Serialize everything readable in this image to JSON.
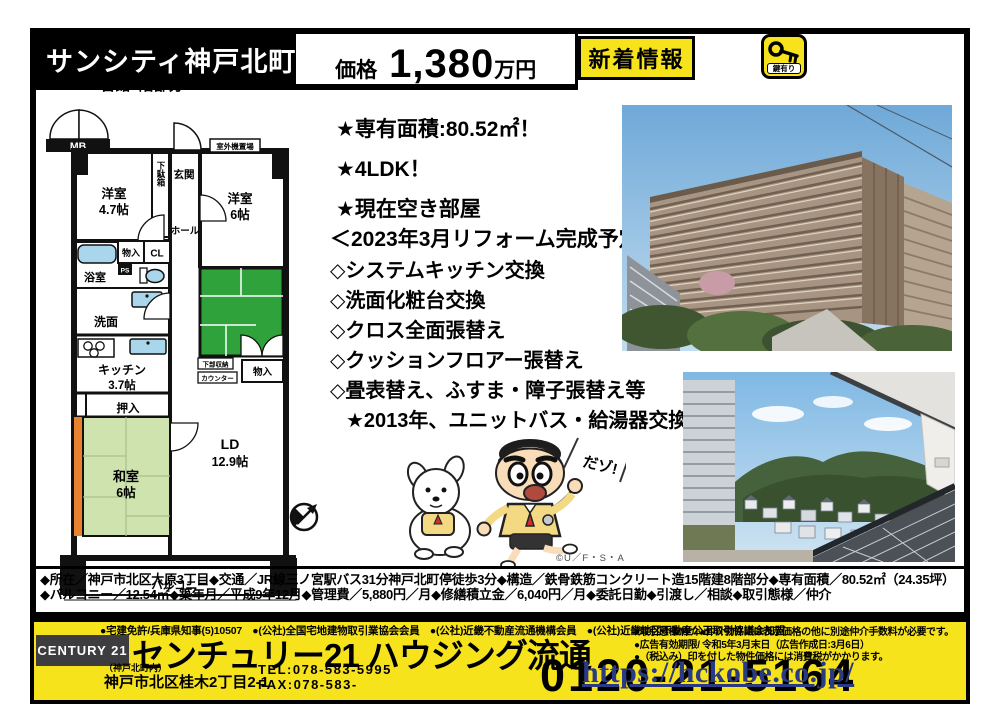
{
  "colors": {
    "accent_yellow": "#f6e31c",
    "tatami_green": "#cfe3ae",
    "dark_green_room": "#2fa23c",
    "orange_strip": "#e8822e",
    "fixture_blue": "#a9d6ea",
    "logo_gray": "#3d3d40",
    "watermark_navy": "#2b3a85"
  },
  "header": {
    "title": "サンシティ神戸北町",
    "price_label": "価格",
    "price_value": "1,380",
    "price_unit": "万円",
    "subtitle": "1番館7階部分",
    "new_badge": "新着情報",
    "key_badge": "鍵有り"
  },
  "highlights": {
    "line1": "★専有面積:80.52㎡！",
    "line2": "★4LDK！",
    "line3": "★現在空き部屋"
  },
  "reform": {
    "heading": "＜2023年3月リフォーム完成予定＞",
    "item1": "◇システムキッチン交換",
    "item2": "◇洗面化粧台交換",
    "item3": "◇クロス全面張替え",
    "item4": "◇クッションフロアー張替え",
    "item5": "◇畳表替え、ふすま・障子張替え等",
    "note": "★2013年、ユニットバス・給湯器交換"
  },
  "floorplan": {
    "mb": "MB",
    "outdoor_unit": "室外機置場",
    "entrance": "玄関",
    "shoe_box": "下駄箱",
    "western1": "洋室",
    "western1_size": "4.7帖",
    "western2": "洋室",
    "western2_size": "6帖",
    "hall": "ホール",
    "storage1": "物入",
    "closet": "CL",
    "ps": "PS",
    "bath": "浴室",
    "washroom": "洗面",
    "kitchen": "キッチン",
    "kitchen_size": "3.7帖",
    "oshiire": "押入",
    "japanese": "和室",
    "japanese_size": "6帖",
    "ld": "LD",
    "ld_size": "12.9帖",
    "lower_storage": "下部収納",
    "counter": "カウンター",
    "storage2": "物入",
    "balcony": "バルコニー"
  },
  "illustration": {
    "speech": "だゾ!",
    "copyright": "©U／F・S・A・A"
  },
  "details": "◆所在／神戸市北区大原3丁目◆交通／JR線三ノ宮駅バス31分神戸北町停徒歩3分◆構造／鉄骨鉄筋コンクリート造15階建8階部分◆専有面積／80.52㎡（24.35坪）◆バルコニー／12.54㎡◆築年月／平成9年12月◆管理費／5,880円／月◆修繕積立金／6,040円／月◆委託日勤◆引渡し／相談◆取引態様／仲介",
  "footer": {
    "memberships": "●宅建免許/兵庫県知事(5)10507　●(公社)全国宅地建物取引業協会会員　●(公社)近畿不動産流通機構会員　●(公社)近畿地区不動産公正取引協議会加盟",
    "logo": "CENTURY 21",
    "company": "センチュリー21 ハウジング流通",
    "office_note": "（神戸北町内）",
    "address": "神戸市北区桂木2丁目2-1",
    "tel": "TEL:078-583-5995",
    "fax": "FAX:078-583-",
    "note1": "●取引態様/仲介●仲介物件には表示価格の他に別途仲介手数料が必要です。",
    "note2": "●広告有効期限/ 令和5年3月末日（広告作成日:3月6日）",
    "note3": "●（税込み）印を付した物件価格には消費税がかかります。",
    "phone": "0120-21-5164"
  },
  "watermark": "https://hckobe.co.jp/"
}
